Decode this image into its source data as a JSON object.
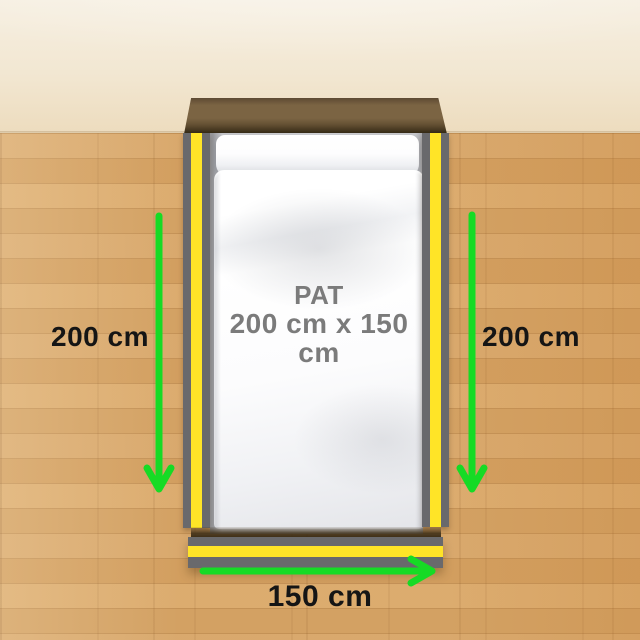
{
  "bed": {
    "name": "PAT",
    "size": "200 cm x 150 cm"
  },
  "measurements": {
    "left": "200 cm",
    "right": "200 cm",
    "bottom": "150 cm"
  },
  "colors": {
    "arrow-green": "#16DB25",
    "rail-yellow": "#FFE427",
    "rail-gray": "#69696C",
    "headboard-face": "#7B6443",
    "headboard-dark": "#44361F",
    "floor-wood": "#D7A465",
    "wall-cream": "#F2E7D2",
    "measure-text": "#151515",
    "bed-text": "#7B7B7B"
  }
}
